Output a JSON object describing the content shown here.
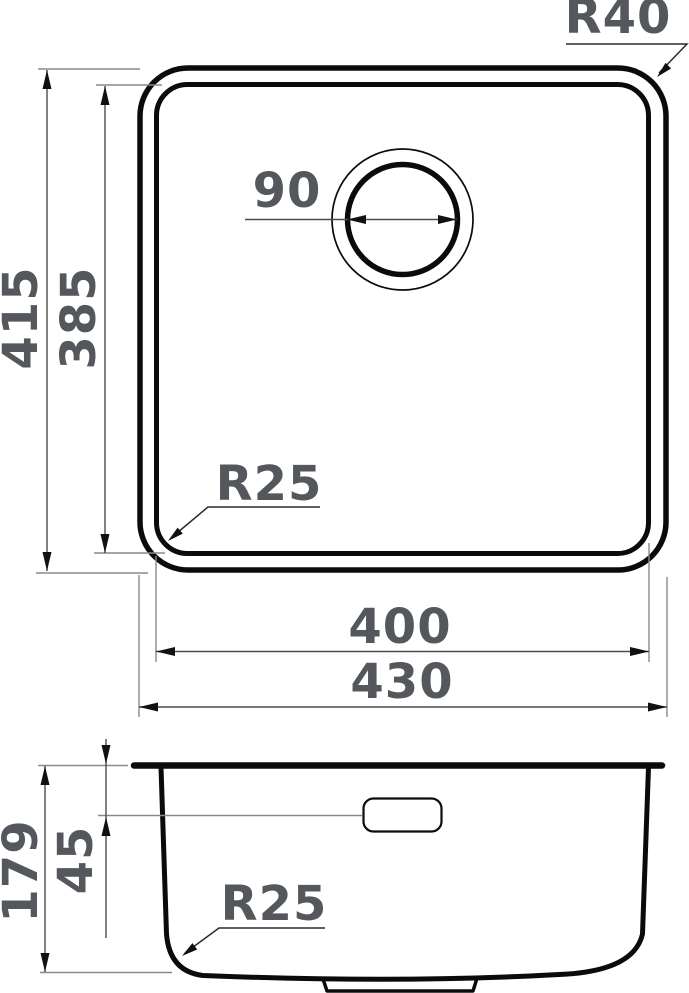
{
  "top_view": {
    "outer_height": "415",
    "inner_height": "385",
    "drain_diameter": "90",
    "outer_corner_radius": "R40",
    "inner_corner_radius": "R25",
    "inner_width": "400",
    "outer_width": "430"
  },
  "side_view": {
    "total_depth": "179",
    "overflow_depth": "45",
    "bottom_corner_radius": "R25"
  },
  "colors": {
    "outline": "#0b0b0b",
    "dimension_line": "#4c4c4c",
    "extension_line": "#8a8a8a",
    "label_text": "#54575b",
    "arrowhead": "#111111",
    "background": "#ffffff"
  }
}
